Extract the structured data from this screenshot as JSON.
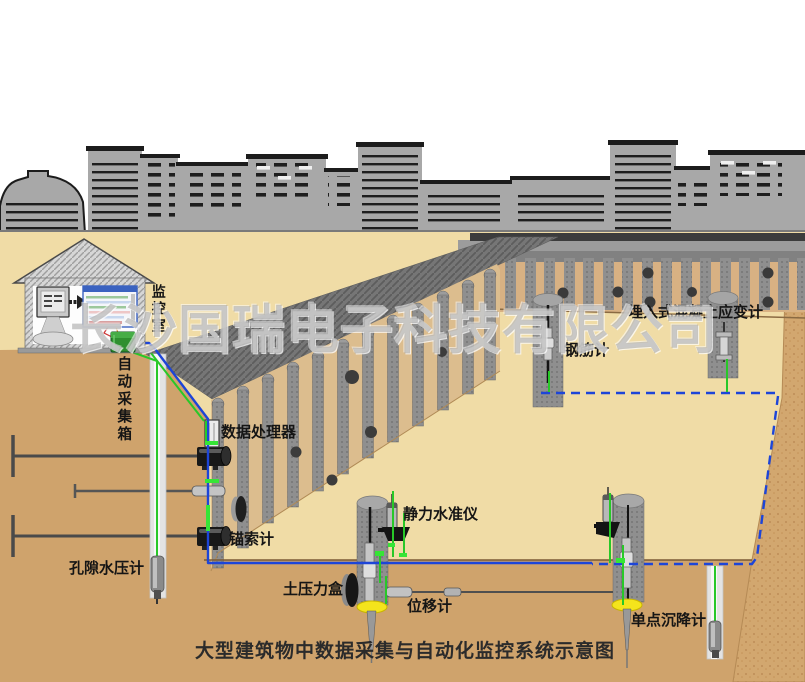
{
  "scene": {
    "watermark": "长沙国瑞电子科技有限公司",
    "caption": "大型建筑物中数据采集与自动化监控系统示意图",
    "labels": {
      "monitoring_room": "监控室",
      "auto_collection_box": "自动采集箱",
      "data_processor": "数据处理器",
      "anchor_cable_gauge": "锚索计",
      "pore_water_pressure_gauge": "孔隙水压计",
      "earth_pressure_cell": "土压力盒",
      "static_level": "静力水准仪",
      "displacement_gauge": "位移计",
      "single_point_settlement_gauge": "单点沉降计",
      "rebar_gauge": "钢筋计",
      "embedded_concrete_strain_gauge": "埋入式混凝土应变计"
    },
    "colors": {
      "sky": "#ffffff",
      "skyline_gray": "#a8a8a8",
      "surface_tan": "#f0dca6",
      "soil_brown": "#cfa36c",
      "wall_tan": "#dcbd8e",
      "pile_gray": "#8f8f8f",
      "embankment_gray": "#767676",
      "cable_blue": "#1d45d8",
      "cable_green": "#28c828",
      "collection_box_green": "#2f8f2f",
      "pile_base_yellow": "#f4e41c"
    }
  }
}
